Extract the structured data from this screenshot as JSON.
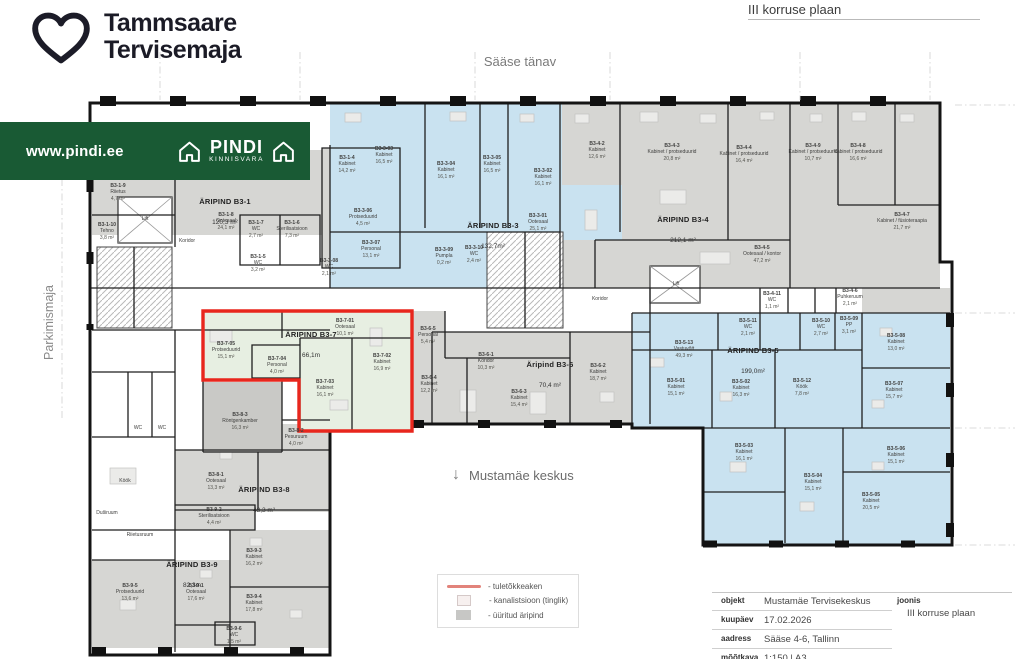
{
  "header": {
    "brand_line1": "Tammsaare",
    "brand_line2": "Tervisemaja",
    "plan_title": "III korruse plaan"
  },
  "banner": {
    "url": "www.pindi.ee",
    "logo_title": "PINDI",
    "logo_subtitle": "KINNISVARA"
  },
  "map_labels": {
    "street": "Sääse tänav",
    "parking": "Parkimismaja",
    "south": "Mustamäe keskus",
    "south_arrow": "↓"
  },
  "legend": {
    "items": [
      {
        "swatch": "fire",
        "label": "- tuletõkkeaken"
      },
      {
        "swatch": "canal",
        "label": "- kanalistsioon (tinglik)"
      },
      {
        "swatch": "rented",
        "label": "- üüritud äripind"
      }
    ]
  },
  "title_block": {
    "rows": [
      {
        "label": "objekt",
        "value": "Mustamäe Tervisekeskus"
      },
      {
        "label": "kuupäev",
        "value": "17.02.2026"
      },
      {
        "label": "aadress",
        "value": "Sääse 4-6, Tallinn"
      },
      {
        "label": "mõõtkava",
        "value": "1:150 | A3"
      }
    ],
    "joonis_label": "joonis",
    "joonis_value": "III korruse plaan"
  },
  "colors": {
    "brand_green": "#195a34",
    "rented_gray": "#d6d6d3",
    "medical_blue": "#c9e2f0",
    "highlight_green": "#e7efe2",
    "highlight_red": "#e8261d"
  },
  "plan": {
    "areas": [
      {
        "name": "ÄRIPIND B3-1",
        "area": "120,3 m²",
        "x": 225,
        "y": 190
      },
      {
        "name": "ÄRIPIND B3-3",
        "area": "132,7m²",
        "x": 493,
        "y": 214
      },
      {
        "name": "ÄRIPIND B3-4",
        "area": "212,1 m²",
        "x": 683,
        "y": 208
      },
      {
        "name": "ÄRIPIND B3-5",
        "area": "199,0m²",
        "x": 753,
        "y": 339
      },
      {
        "name": "Äripind B3-6",
        "area": "70,4 m²",
        "x": 550,
        "y": 353
      },
      {
        "name": "ÄRIPIND B3-7",
        "area": "66,1m",
        "x": 311,
        "y": 323
      },
      {
        "name": "ÄRIPIND B3-8",
        "area": "43,3 m²",
        "x": 264,
        "y": 478
      },
      {
        "name": "ÄRIPIND B3-9",
        "area": "82,3m",
        "x": 192,
        "y": 553
      }
    ],
    "rooms": [
      {
        "code": "B3-1-9",
        "name": "Riietus",
        "area": "4,7 m²",
        "x": 118,
        "y": 183
      },
      {
        "code": "B3-1-10",
        "name": "Tehno",
        "area": "3,8 m²",
        "x": 107,
        "y": 222
      },
      {
        "name": "Lift",
        "x": 145,
        "y": 216
      },
      {
        "name": "Koridor",
        "x": 187,
        "y": 238
      },
      {
        "code": "B3-1-8",
        "name": "Ootesaal",
        "area": "24,1 m²",
        "x": 226,
        "y": 212
      },
      {
        "code": "B3-1-7",
        "name": "WC",
        "area": "2,7 m²",
        "x": 256,
        "y": 220
      },
      {
        "code": "B3-1-6",
        "name": "Sterilisatsioon",
        "area": "7,3 m²",
        "x": 292,
        "y": 220
      },
      {
        "code": "B3-1-5",
        "name": "WC",
        "area": "3,2 m²",
        "x": 258,
        "y": 254
      },
      {
        "code": "B3-1-4",
        "name": "Kabinet",
        "area": "14,2 m²",
        "x": 347,
        "y": 155
      },
      {
        "code": "B3-3-03",
        "name": "Kabinet",
        "area": "16,5 m²",
        "x": 384,
        "y": 146
      },
      {
        "code": "B3-3-04",
        "name": "Kabinet",
        "area": "16,1 m²",
        "x": 446,
        "y": 161
      },
      {
        "code": "B3-3-05",
        "name": "Kabinet",
        "area": "16,5 m²",
        "x": 492,
        "y": 155
      },
      {
        "code": "B3-3-02",
        "name": "Kabinet",
        "area": "16,1 m²",
        "x": 543,
        "y": 168
      },
      {
        "code": "B3-3-01",
        "name": "Ootesaal",
        "area": "25,1 m²",
        "x": 538,
        "y": 213
      },
      {
        "code": "B3-3-06",
        "name": "Protseduurid",
        "area": "4,5 m²",
        "x": 363,
        "y": 208
      },
      {
        "code": "B3-3-07",
        "name": "Personal",
        "area": "13,1 m²",
        "x": 371,
        "y": 240
      },
      {
        "code": "B3-3-08",
        "name": "WC",
        "area": "2,1 m²",
        "x": 329,
        "y": 258
      },
      {
        "code": "B3-3-09",
        "name": "Pumpla",
        "area": "0,2 m²",
        "x": 444,
        "y": 247
      },
      {
        "code": "B3-3-10",
        "name": "WC",
        "area": "2,4 m²",
        "x": 474,
        "y": 245
      },
      {
        "code": "B3-4-2",
        "name": "Kabinet",
        "area": "12,6 m²",
        "x": 597,
        "y": 141
      },
      {
        "code": "B3-4-3",
        "name": "Kabinet / protseduurid",
        "area": "20,8 m²",
        "x": 672,
        "y": 143
      },
      {
        "code": "B3-4-4",
        "name": "Kabinet / protseduurid",
        "area": "16,4 m²",
        "x": 744,
        "y": 145
      },
      {
        "code": "B3-4-5",
        "name": "Ootesaal / kontor",
        "area": "47,2 m²",
        "x": 762,
        "y": 245
      },
      {
        "code": "B3-4-9",
        "name": "Kabinet / protseduurid",
        "area": "10,7 m²",
        "x": 813,
        "y": 143
      },
      {
        "code": "B3-4-8",
        "name": "Kabinet / protseduurid",
        "area": "16,6 m²",
        "x": 858,
        "y": 143
      },
      {
        "code": "B3-4-7",
        "name": "Kabinet / füsioteraapia",
        "area": "21,7 m²",
        "x": 902,
        "y": 212
      },
      {
        "code": "B3-4-11",
        "name": "WC",
        "area": "1,1 m²",
        "x": 772,
        "y": 291
      },
      {
        "code": "B3-4-6",
        "name": "Puhkeruum",
        "area": "2,1 m²",
        "x": 850,
        "y": 288
      },
      {
        "code": "B3-5-13",
        "name": "Vastuvõtt",
        "area": "49,3 m²",
        "x": 684,
        "y": 340
      },
      {
        "code": "B3-5-11",
        "name": "WC",
        "area": "2,1 m²",
        "x": 748,
        "y": 318
      },
      {
        "code": "B3-5-10",
        "name": "WC",
        "area": "2,7 m²",
        "x": 821,
        "y": 318
      },
      {
        "code": "B3-5-09",
        "name": "PP",
        "area": "3,1 m²",
        "x": 849,
        "y": 316
      },
      {
        "code": "B3-5-01",
        "name": "Kabinet",
        "area": "15,1 m²",
        "x": 676,
        "y": 378
      },
      {
        "code": "B3-5-02",
        "name": "Kabinet",
        "area": "16,3 m²",
        "x": 741,
        "y": 379
      },
      {
        "code": "B3-5-12",
        "name": "Köök",
        "area": "7,8 m²",
        "x": 802,
        "y": 378
      },
      {
        "code": "B3-5-08",
        "name": "Kabinet",
        "area": "13,0 m²",
        "x": 896,
        "y": 333
      },
      {
        "code": "B3-5-07",
        "name": "Kabinet",
        "area": "15,7 m²",
        "x": 894,
        "y": 381
      },
      {
        "code": "B3-5-03",
        "name": "Kabinet",
        "area": "16,1 m²",
        "x": 744,
        "y": 443
      },
      {
        "code": "B3-5-04",
        "name": "Kabinet",
        "area": "15,1 m²",
        "x": 813,
        "y": 473
      },
      {
        "code": "B3-5-06",
        "name": "Kabinet",
        "area": "15,1 m²",
        "x": 896,
        "y": 446
      },
      {
        "code": "B3-5-05",
        "name": "Kabinet",
        "area": "20,5 m²",
        "x": 871,
        "y": 492
      },
      {
        "code": "B3-6-1",
        "name": "Koridor",
        "area": "10,3 m²",
        "x": 486,
        "y": 352
      },
      {
        "code": "B3-6-2",
        "name": "Kabinet",
        "area": "18,7 m²",
        "x": 598,
        "y": 363
      },
      {
        "code": "B3-6-3",
        "name": "Kabinet",
        "area": "15,4 m²",
        "x": 519,
        "y": 389
      },
      {
        "code": "B3-6-5",
        "name": "Personal",
        "area": "5,4 m²",
        "x": 428,
        "y": 326
      },
      {
        "code": "B3-6-4",
        "name": "Kabinet",
        "area": "12,2 m²",
        "x": 429,
        "y": 375
      },
      {
        "code": "B3-7-05",
        "name": "Protseduurid",
        "area": "15,1 m²",
        "x": 226,
        "y": 341
      },
      {
        "code": "B3-7-01",
        "name": "Ootesaal",
        "area": "10,1 m²",
        "x": 345,
        "y": 318
      },
      {
        "code": "B3-7-04",
        "name": "Personal",
        "area": "4,0 m²",
        "x": 277,
        "y": 356
      },
      {
        "code": "B3-7-02",
        "name": "Kabinet",
        "area": "16,9 m²",
        "x": 382,
        "y": 353
      },
      {
        "code": "B3-7-03",
        "name": "Kabinet",
        "area": "16,1 m²",
        "x": 325,
        "y": 379
      },
      {
        "code": "B3-8-3",
        "name": "Röntgenkamber",
        "area": "16,3 m²",
        "x": 240,
        "y": 412
      },
      {
        "code": "B3-8-2",
        "name": "Pesuruum",
        "area": "4,0 m²",
        "x": 296,
        "y": 428
      },
      {
        "code": "B3-8-1",
        "name": "Ootesaal",
        "area": "13,3 m²",
        "x": 216,
        "y": 472
      },
      {
        "code": "B3-9-2",
        "name": "Sterilisatsioon",
        "area": "4,4 m²",
        "x": 214,
        "y": 507
      },
      {
        "code": "B3-9-3",
        "name": "Kabinet",
        "area": "16,2 m²",
        "x": 254,
        "y": 548
      },
      {
        "code": "B3-9-1",
        "name": "Ootesaal",
        "area": "17,6 m²",
        "x": 196,
        "y": 583
      },
      {
        "code": "B3-9-5",
        "name": "Protseduurid",
        "area": "13,6 m²",
        "x": 130,
        "y": 583
      },
      {
        "code": "B3-9-4",
        "name": "Kabinet",
        "area": "17,8 m²",
        "x": 254,
        "y": 594
      },
      {
        "code": "B3-9-6",
        "name": "WC",
        "area": "1,5 m²",
        "x": 234,
        "y": 626
      },
      {
        "name": "Köök",
        "x": 125,
        "y": 478
      },
      {
        "name": "Riietusruum",
        "x": 140,
        "y": 532
      },
      {
        "name": "Duširuum",
        "x": 107,
        "y": 510
      },
      {
        "name": "WC",
        "x": 138,
        "y": 425
      },
      {
        "name": "WC",
        "x": 162,
        "y": 425
      },
      {
        "name": "Lift",
        "x": 676,
        "y": 281
      },
      {
        "name": "Koridor",
        "x": 600,
        "y": 296
      }
    ]
  }
}
